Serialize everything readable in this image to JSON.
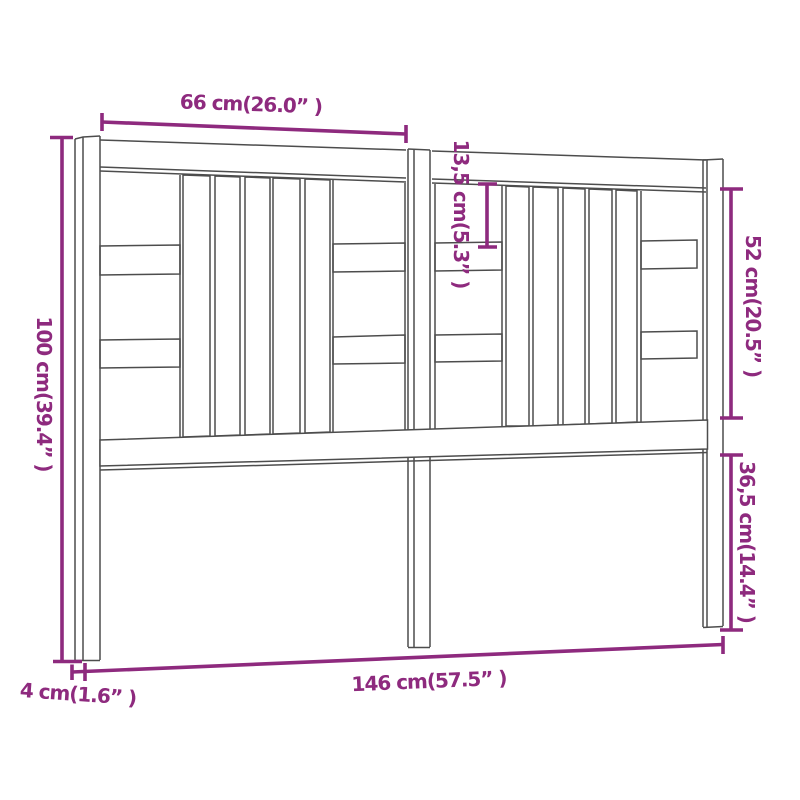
{
  "diagram": {
    "title": "headboard-dimension-diagram",
    "product": "bed headboard line drawing",
    "accent_color": "#8e2a7e",
    "line_color": "#4d4d4d",
    "background_color": "#ffffff",
    "dimensions": [
      {
        "id": "top-half-width",
        "label": "66 cm(26.0” )"
      },
      {
        "id": "slat-gap-height",
        "label": "13,5 cm(5.3” )"
      },
      {
        "id": "upper-section-height",
        "label": "52 cm(20.5” )"
      },
      {
        "id": "leg-section-height",
        "label": "36,5 cm(14.4” )"
      },
      {
        "id": "total-height",
        "label": "100 cm(39.4” )"
      },
      {
        "id": "total-width",
        "label": "146 cm(57.5” )"
      },
      {
        "id": "post-thickness",
        "label": "4 cm(1.6” )"
      }
    ]
  }
}
